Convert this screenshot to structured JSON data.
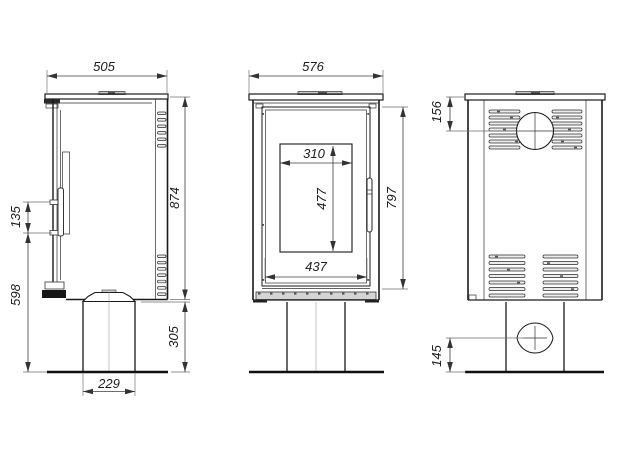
{
  "dimensions": {
    "side": {
      "depth": "505",
      "total_height": "874",
      "handle_length": "135",
      "handle_height_from_floor": "598",
      "pedestal_height": "305",
      "pedestal_width": "229"
    },
    "front": {
      "width": "576",
      "body_height": "797",
      "glass_width": "310",
      "glass_height": "477",
      "door_width": "437"
    },
    "back": {
      "flue_center_from_top": "156",
      "air_inlet_center_from_floor": "145"
    }
  }
}
